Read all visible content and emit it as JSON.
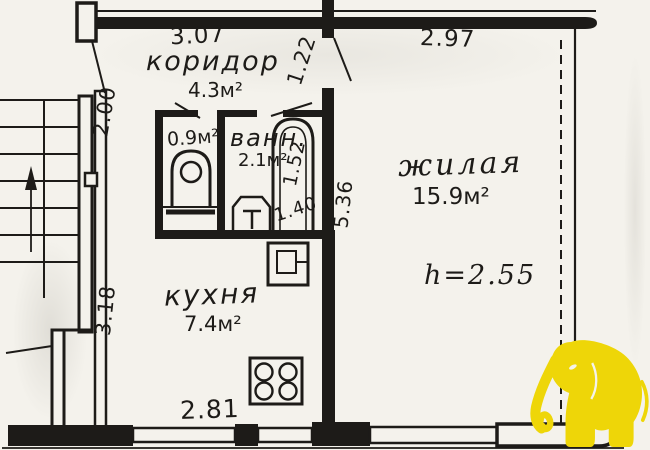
{
  "plan_type": "apartment-floor-plan",
  "rooms": {
    "corridor": {
      "name": "коридор",
      "area": "4.3м²"
    },
    "wc": {
      "area": "0.9м²"
    },
    "bath": {
      "name": "ванн.",
      "area": "2.1м²"
    },
    "living": {
      "name": "жилая",
      "area": "15.9м²",
      "ceiling": "h=2.55"
    },
    "kitchen": {
      "name": "кухня",
      "area": "7.4м²"
    }
  },
  "dims": {
    "corridor_width": "3.07",
    "living_width": "2.97",
    "corridor_passage": "1.22",
    "entry_wall": "2.00",
    "bath_width": "1.52",
    "bath_depth": "1.40",
    "living_depth": "5.36",
    "kitchen_depth": "3.18",
    "kitchen_width": "2.81"
  },
  "colors": {
    "paper": "#f4f2ec",
    "ink": "#1d1b18",
    "elephant": "#eed608"
  }
}
